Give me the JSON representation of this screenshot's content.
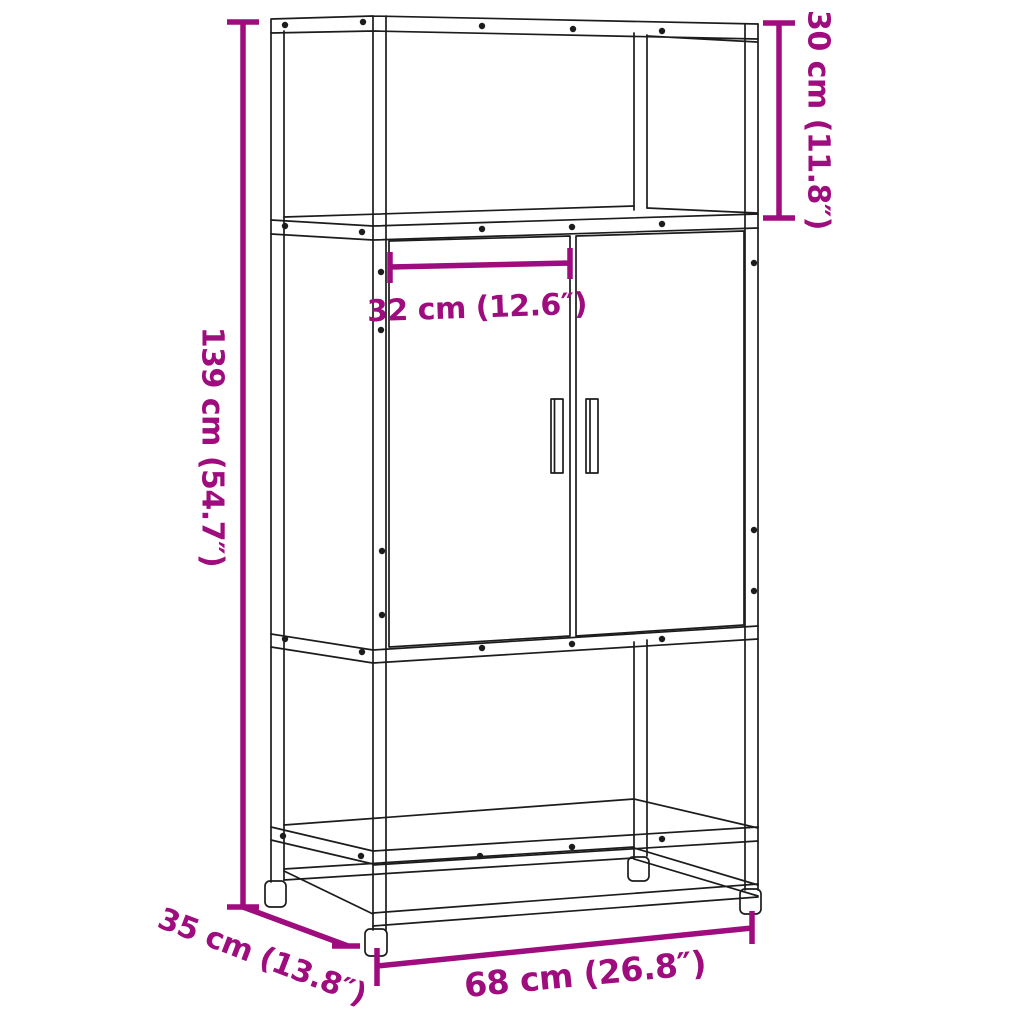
{
  "page": {
    "background": "#ffffff"
  },
  "diagram": {
    "accent_color": "#9E0C7E",
    "line_color": "#1c1c1c",
    "labels": {
      "height": "139 cm (54.7″)",
      "top_compartment_height": "30 cm (11.8″)",
      "inner_width": "32 cm (12.6″)",
      "depth": "35 cm (13.8″)",
      "width": "68 cm (26.8″)"
    }
  }
}
